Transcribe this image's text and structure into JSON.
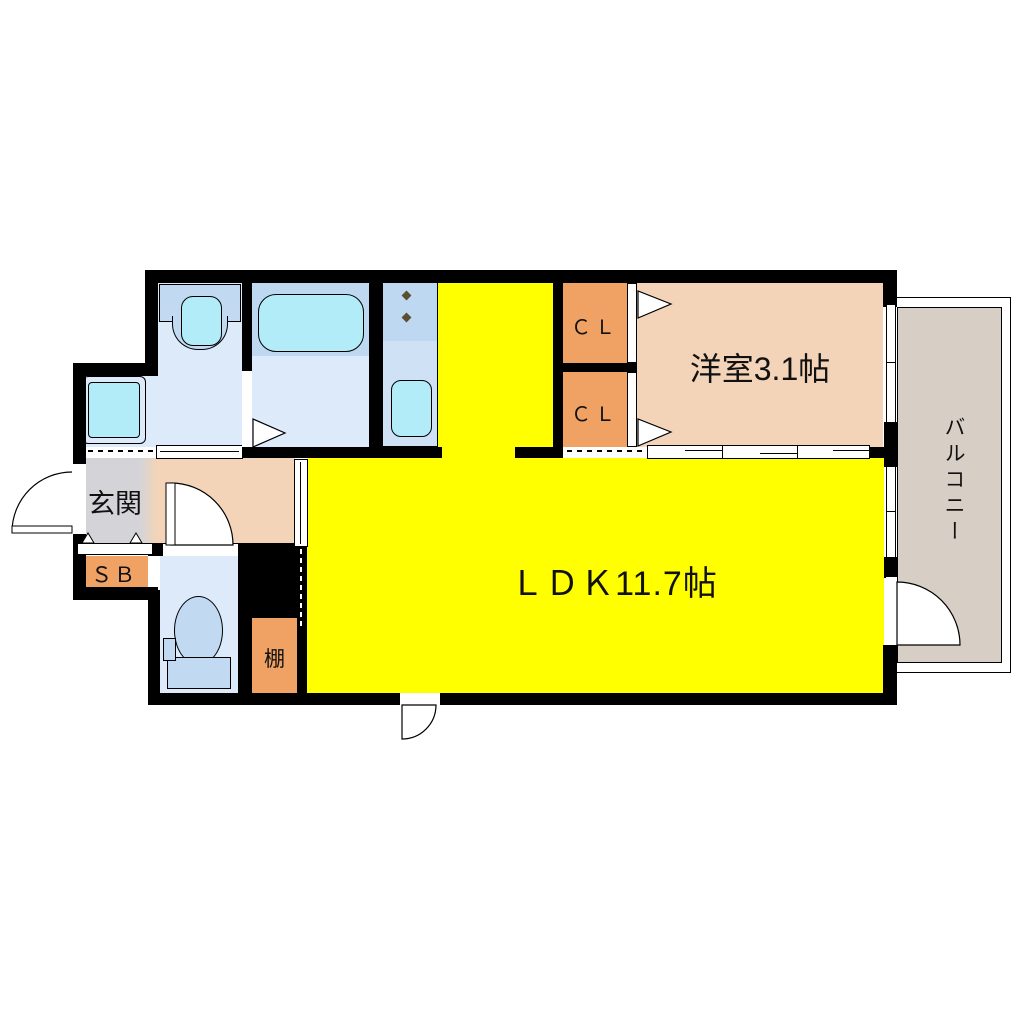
{
  "floorplan": {
    "rooms": {
      "ldk": {
        "label": "ＬＤＫ11.7帖",
        "color": "#ffff00"
      },
      "western_room": {
        "label": "洋室3.1帖",
        "color": "#f3d4b8"
      },
      "balcony": {
        "label": "バルコニー",
        "color": "#d7cfc6"
      },
      "entrance": {
        "label": "玄関",
        "color": "#d4d4d8"
      },
      "shoe_box": {
        "label": "ＳＢ",
        "color": "#efa263"
      },
      "closet_upper": {
        "label": "ＣＬ",
        "color": "#efa263"
      },
      "closet_lower": {
        "label": "ＣＬ",
        "color": "#efa263"
      },
      "shelf": {
        "label": "棚",
        "color": "#efa263"
      },
      "hall": {
        "color": "#f3d4b8"
      },
      "washroom": {
        "color": "#dceafa"
      },
      "bathroom": {
        "color": "#dceafa"
      },
      "toilet_room": {
        "color": "#dceafa"
      }
    },
    "fixtures": {
      "bathtub": "bathtub",
      "vanity_sink": "vanity-sink",
      "washing_machine_pan": "washing-machine-pan",
      "kitchen_stove": "kitchen-stove-burners",
      "kitchen_sink": "kitchen-sink",
      "toilet": "toilet"
    },
    "colors": {
      "wall": "#000000",
      "water_fixture": "#b2ecf9",
      "counter_fixture": "#c2d9f2",
      "kitchen_counter": "#cfe2f5",
      "bath_band": "#bed8f2"
    }
  }
}
